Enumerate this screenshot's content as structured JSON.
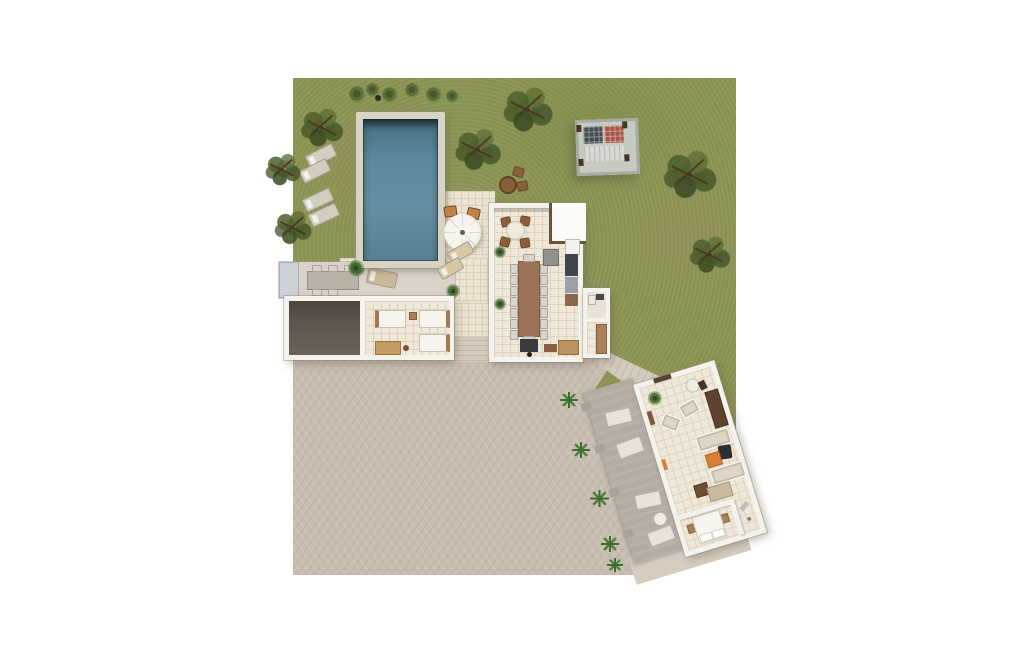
{
  "scene": {
    "kind": "architectural-site-plan-3d-top-view",
    "background_color": "#ffffff",
    "visible_text": "none"
  },
  "palette": {
    "grass": "#8f9857",
    "pool_water": "#5d8a9c",
    "pool_water_shadow": "#2e4854",
    "pool_coping": "#d9d3c3",
    "tile_patio": "#ece4d3",
    "house_floor": "#efe8d9",
    "terrace_paving": "#c8bdb1",
    "walkway_deck": "#b3aca2",
    "walls": "#f3f2ed",
    "garage_floor": "#564f48",
    "wood_dark": "#5f4330",
    "wood_mid": "#9b7355",
    "accent_orange": "#d97e35",
    "solar_panel_grey": "#474c52",
    "solar_panel_red": "#a8564a"
  },
  "areas": {
    "garden": "grass lawn with olive trees",
    "pool": "rectangular swimming pool with stone coping",
    "pool_lounge": "four sun loungers on grass west of pool",
    "parasol_patio": "tiled patio with parasol, two chairs and two loungers",
    "pergola": "garden pergola with two rooftop solar panels",
    "garden_table": "small round table with two chairs on lawn",
    "main_house": "open-plan kitchen and dining pavilion",
    "dining": "long table with fourteen side chairs plus round breakfast table",
    "annex": "small bathroom and storage annex",
    "bedroom_wing": "room with three single beds and a wooden chest",
    "garage": "dark-floored garage / storage room",
    "outdoor_dining": "covered outdoor dining terrace with long table",
    "terrace": "large herringbone paved terrace",
    "walkway": "angled deck with loungers, side table and agave plants",
    "guest_house": "rotated guest house with lounge, bedroom and shower room"
  },
  "counts": {
    "trees": 7,
    "bushes": 6,
    "agave_plants": 5,
    "sun_loungers_grass": 4,
    "sun_loungers_patio": 2,
    "deck_loungers": 4,
    "single_beds": 3,
    "double_beds": 1,
    "long_table_chairs": 16,
    "solar_panels": 2
  }
}
